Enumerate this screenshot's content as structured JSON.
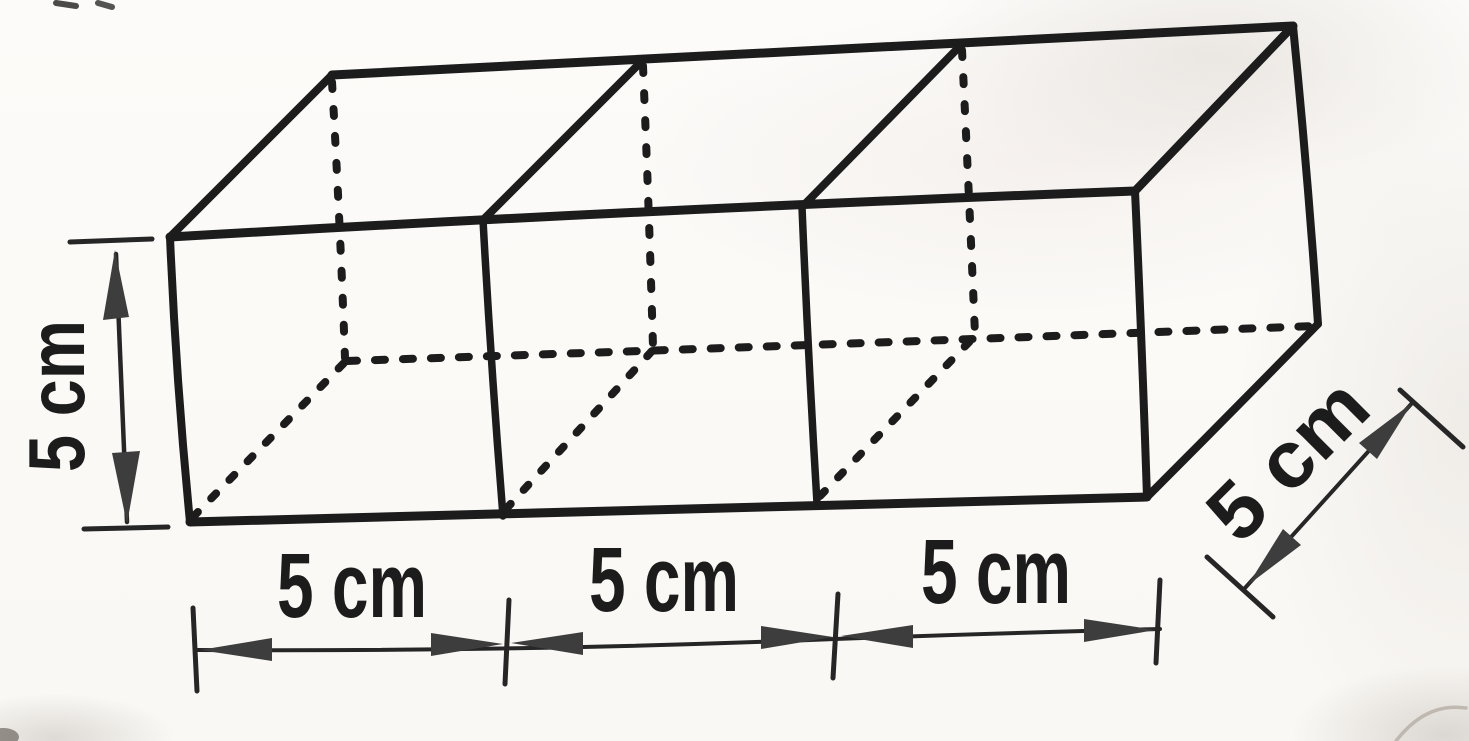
{
  "figure_labels": {
    "height": "5 cm",
    "width_segment_1": "5 cm",
    "width_segment_2": "5 cm",
    "width_segment_3": "5 cm",
    "depth": "5 cm"
  },
  "colors": {
    "ink": "#1c1c1c",
    "dimension_ink": "#262626",
    "arrow_fill": "#3d3d3d",
    "paper": "#fbfaf7"
  }
}
